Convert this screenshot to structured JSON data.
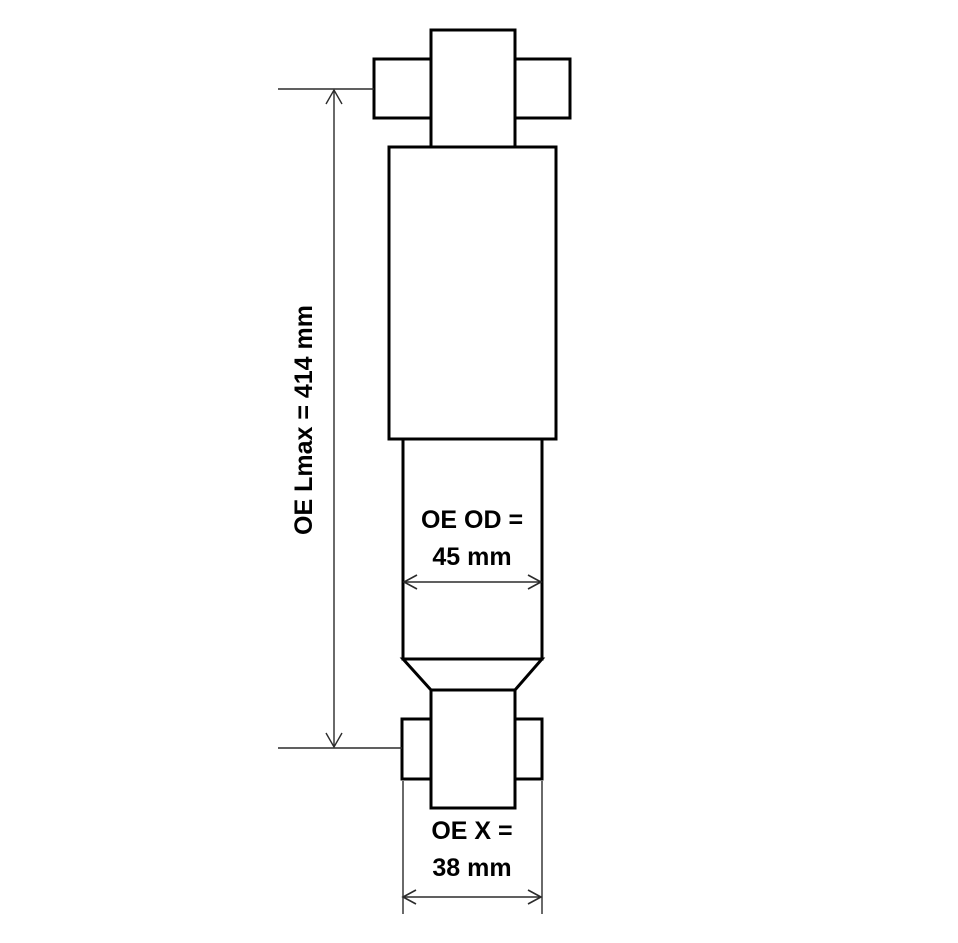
{
  "canvas": {
    "width": 958,
    "height": 943,
    "background": "#ffffff"
  },
  "colors": {
    "outline": "#000000",
    "dimension_line": "#2b2b2b",
    "text": "#000000"
  },
  "labels": {
    "lmax": "OE Lmax = 414 mm",
    "od_line1": "OE OD =",
    "od_line2": "45 mm",
    "x_line1": "OE X =",
    "x_line2": "38 mm"
  },
  "dimensions": {
    "lmax_mm": 414,
    "od_mm": 45,
    "x_mm": 38
  }
}
